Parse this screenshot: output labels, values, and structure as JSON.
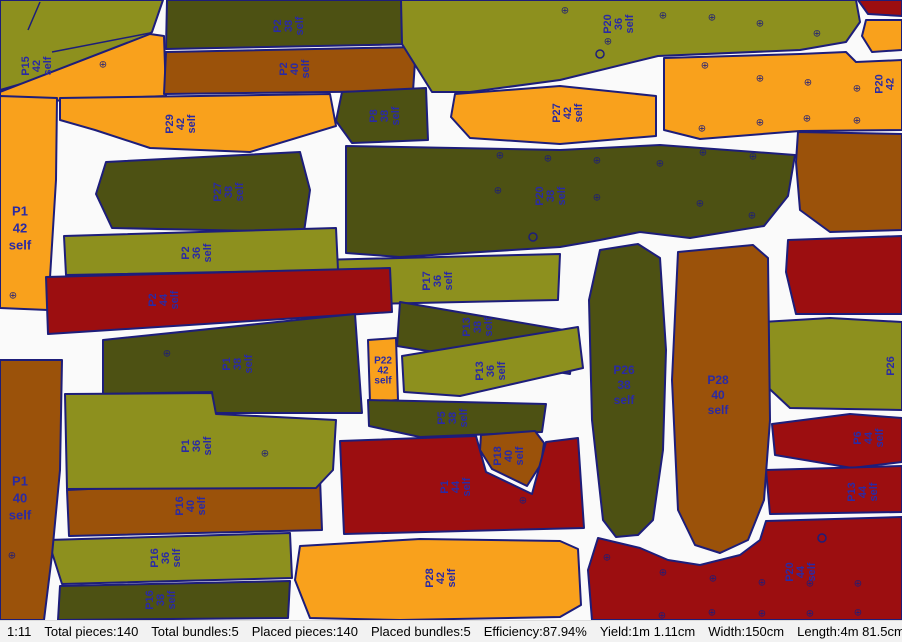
{
  "window": {
    "title": "Marker nesting view"
  },
  "status_bar": {
    "items": [
      "1:11",
      "Total pieces:140",
      "Total bundles:5",
      "Placed pieces:140",
      "Placed bundles:5",
      "Efficiency:87.94%",
      "Yield:1m 1.11cm",
      "Width:150cm",
      "Length:4m 81.5cm"
    ]
  },
  "colors": {
    "size36": "#8d901e",
    "size38": "#4d5113",
    "size40": "#9b520a",
    "size42": "#f9a11c",
    "size44": "#9c0e10",
    "outline": "#1d1d7a",
    "label": "#2a2aa4",
    "background": "#fafafa",
    "statusbar_bg": "#f2f2f2"
  },
  "symbols": {
    "drill": "⊕"
  },
  "canvas": {
    "width": 902,
    "height": 620
  },
  "pieces": [
    {
      "id": "p36-top-left",
      "color": "size36",
      "points": "0,0 163,0 152,32 118,56 0,90",
      "lines": [
        [
          40,
          2,
          28,
          30
        ]
      ]
    },
    {
      "id": "P15-42",
      "color": "size42",
      "points": "0,92 150,34 164,36 166,96 0,103",
      "label": {
        "x": 36,
        "y": 66,
        "rot": -90,
        "lines": [
          "P15",
          "42",
          "self"
        ]
      },
      "drills": [
        [
          103,
          64
        ]
      ],
      "lines": [
        [
          52,
          52,
          150,
          33
        ]
      ]
    },
    {
      "id": "P2-38",
      "color": "size38",
      "points": "167,0 420,0 417,44 166,49",
      "label": {
        "x": 288,
        "y": 26,
        "rot": -90,
        "lines": [
          "P2",
          "38",
          "self"
        ]
      }
    },
    {
      "id": "P2-40",
      "color": "size40",
      "points": "166,52 416,47 413,91 164,94",
      "label": {
        "x": 294,
        "y": 69,
        "rot": -90,
        "lines": [
          "P2",
          "40",
          "self"
        ]
      }
    },
    {
      "id": "P29-42",
      "color": "size42",
      "points": "60,98 200,96 330,94 336,126 250,152 150,148 95,130 60,120",
      "label": {
        "x": 180,
        "y": 124,
        "rot": -90,
        "lines": [
          "P29",
          "42",
          "self"
        ]
      }
    },
    {
      "id": "P1-42",
      "color": "size42",
      "points": "0,96 57,98 56,180 48,310 0,308",
      "label": {
        "x": 20,
        "y": 228,
        "rot": 0,
        "size": 13,
        "lh": 17,
        "lines": [
          "P1",
          "42",
          "self"
        ]
      },
      "drills": [
        [
          13,
          295
        ]
      ]
    },
    {
      "id": "P8-38",
      "color": "size38",
      "points": "342,92 426,88 428,140 352,143 336,121",
      "label": {
        "x": 384,
        "y": 116,
        "rot": -90,
        "lines": [
          "P8",
          "38",
          "self"
        ]
      }
    },
    {
      "id": "P20-36",
      "color": "size36",
      "points": "401,0 856,0 860,22 846,42 800,50 658,56 560,80 470,92 432,92 402,44",
      "label": {
        "x": 618,
        "y": 24,
        "rot": -90,
        "lines": [
          "P20",
          "36",
          "self"
        ]
      },
      "drills": [
        [
          565,
          10
        ],
        [
          663,
          15
        ],
        [
          712,
          17
        ],
        [
          760,
          23
        ],
        [
          817,
          33
        ],
        [
          608,
          41
        ]
      ],
      "circles": [
        [
          600,
          54
        ]
      ]
    },
    {
      "id": "P27-42",
      "color": "size42",
      "points": "455,94 560,86 656,96 656,136 560,144 470,138 451,117",
      "label": {
        "x": 567,
        "y": 113,
        "rot": -90,
        "lines": [
          "P27",
          "42",
          "self"
        ]
      }
    },
    {
      "id": "P20-42",
      "color": "size42",
      "points": "664,58 800,54 846,52 856,62 902,60 902,130 800,131 700,139 664,130",
      "label": {
        "x": 884,
        "y": 84,
        "rot": -90,
        "lines": [
          "P20",
          "42"
        ]
      },
      "drills": [
        [
          705,
          65
        ],
        [
          760,
          78
        ],
        [
          808,
          82
        ],
        [
          857,
          88
        ],
        [
          702,
          128
        ],
        [
          760,
          122
        ],
        [
          807,
          118
        ],
        [
          857,
          120
        ]
      ]
    },
    {
      "id": "p44-wedge-tr",
      "color": "size44",
      "points": "858,0 902,0 902,16 868,14"
    },
    {
      "id": "p42-wedge-tr",
      "color": "size42",
      "points": "866,20 902,20 902,50 872,52 862,36"
    },
    {
      "id": "P20-38",
      "color": "size38",
      "points": "346,146 560,150 660,145 795,155 788,196 764,226 690,238 640,232 600,240 560,247 400,257 346,253",
      "label": {
        "x": 550,
        "y": 196,
        "rot": -90,
        "lines": [
          "P20",
          "38",
          "self"
        ]
      },
      "drills": [
        [
          500,
          155
        ],
        [
          548,
          158
        ],
        [
          597,
          160
        ],
        [
          498,
          190
        ],
        [
          597,
          197
        ],
        [
          660,
          163
        ],
        [
          703,
          152
        ],
        [
          753,
          156
        ],
        [
          700,
          203
        ],
        [
          752,
          215
        ]
      ],
      "circles": [
        [
          533,
          237
        ]
      ]
    },
    {
      "id": "p40-right",
      "color": "size40",
      "points": "798,132 902,134 902,230 830,232 800,210 796,162"
    },
    {
      "id": "p44-right",
      "color": "size44",
      "points": "788,240 902,236 902,314 796,314 786,272"
    },
    {
      "id": "P26-36",
      "color": "size36",
      "points": "762,322 830,318 902,322 902,410 790,408 760,380 754,344",
      "label": {
        "x": 890,
        "y": 366,
        "rot": -90,
        "lines": [
          "P26"
        ]
      }
    },
    {
      "id": "P6-44",
      "color": "size44",
      "points": "772,424 850,414 902,418 902,462 852,468 775,455",
      "label": {
        "x": 868,
        "y": 438,
        "rot": -90,
        "lines": [
          "P6",
          "44",
          "self"
        ]
      }
    },
    {
      "id": "P13-44",
      "color": "size44",
      "points": "766,470 902,466 902,512 770,514",
      "label": {
        "x": 862,
        "y": 492,
        "rot": -90,
        "lines": [
          "P13",
          "44",
          "self"
        ]
      }
    },
    {
      "id": "P17-36",
      "color": "size36",
      "points": "318,260 560,254 558,300 321,305",
      "label": {
        "x": 437,
        "y": 281,
        "rot": -90,
        "lines": [
          "P17",
          "36",
          "self"
        ]
      }
    },
    {
      "id": "P27-38",
      "color": "size38",
      "points": "106,162 300,152 310,190 304,232 112,228 96,194",
      "label": {
        "x": 228,
        "y": 192,
        "rot": -90,
        "lines": [
          "P27",
          "38",
          "self"
        ]
      }
    },
    {
      "id": "P2-36",
      "color": "size36",
      "points": "64,236 336,228 338,270 66,275",
      "label": {
        "x": 196,
        "y": 253,
        "rot": -90,
        "lines": [
          "P2",
          "36",
          "self"
        ]
      }
    },
    {
      "id": "P2-44",
      "color": "size44",
      "points": "46,277 390,268 392,312 48,334",
      "label": {
        "x": 163,
        "y": 300,
        "rot": -90,
        "lines": [
          "P2",
          "44",
          "self"
        ]
      }
    },
    {
      "id": "P1-38",
      "color": "size38",
      "points": "103,340 355,314 362,413 214,413 212,392 103,394",
      "label": {
        "x": 237,
        "y": 364,
        "rot": -90,
        "lines": [
          "P1",
          "38",
          "self"
        ]
      },
      "drills": [
        [
          167,
          353
        ]
      ]
    },
    {
      "id": "P22-42",
      "color": "size42",
      "points": "368,340 396,338 398,400 370,402",
      "label": {
        "x": 383,
        "y": 370,
        "rot": 0,
        "size": 10,
        "lh": 10,
        "lines": [
          "P22",
          "42",
          "self"
        ]
      }
    },
    {
      "id": "P13-38",
      "color": "size38",
      "points": "400,302 575,332 570,374 397,346",
      "label": {
        "x": 477,
        "y": 327,
        "rot": -90,
        "lines": [
          "P13",
          "38",
          "self"
        ]
      }
    },
    {
      "id": "P13-36",
      "color": "size36",
      "points": "402,356 578,327 583,368 460,396 404,392",
      "label": {
        "x": 490,
        "y": 371,
        "rot": -90,
        "lines": [
          "P13",
          "36",
          "self"
        ]
      }
    },
    {
      "id": "P5-38",
      "color": "size38",
      "points": "368,400 546,404 542,432 420,437 369,426",
      "label": {
        "x": 452,
        "y": 418,
        "rot": -90,
        "lines": [
          "P5",
          "38",
          "self"
        ]
      }
    },
    {
      "id": "P18-40",
      "color": "size40",
      "points": "481,435 535,431 544,443 541,464 527,486 492,469 480,450",
      "label": {
        "x": 508,
        "y": 456,
        "rot": -90,
        "lines": [
          "P18",
          "40",
          "self"
        ]
      }
    },
    {
      "id": "P1-44",
      "color": "size44",
      "points": "340,441 476,436 486,472 532,494 546,442 578,438 584,528 344,534",
      "label": {
        "x": 455,
        "y": 487,
        "rot": -90,
        "lines": [
          "P1",
          "44",
          "self"
        ]
      },
      "drills": [
        [
          523,
          500
        ]
      ]
    },
    {
      "id": "P26-38",
      "color": "size38",
      "points": "600,250 638,244 660,258 666,350 663,450 653,520 638,535 616,537 603,520 592,420 589,300",
      "label": {
        "x": 624,
        "y": 385,
        "rot": 0,
        "size": 12,
        "lh": 15,
        "lines": [
          "P26",
          "38",
          "self"
        ]
      }
    },
    {
      "id": "P28-40",
      "color": "size40",
      "points": "678,252 753,245 768,258 770,420 764,500 748,540 720,553 695,545 678,510 672,380",
      "label": {
        "x": 718,
        "y": 395,
        "rot": 0,
        "size": 12,
        "lh": 15,
        "lines": [
          "P28",
          "40",
          "self"
        ]
      }
    },
    {
      "id": "P28-42",
      "color": "size42",
      "points": "300,546 420,539 560,541 578,549 581,605 560,617 400,620 310,618 295,580",
      "label": {
        "x": 440,
        "y": 578,
        "rot": -90,
        "lines": [
          "P28",
          "42",
          "self"
        ]
      }
    },
    {
      "id": "P20-44",
      "color": "size44",
      "points": "598,538 640,548 668,560 700,565 740,555 760,540 766,521 902,517 902,620 592,620 588,570",
      "label": {
        "x": 800,
        "y": 572,
        "rot": -90,
        "lines": [
          "P20",
          "44",
          "self"
        ]
      },
      "drills": [
        [
          607,
          557
        ],
        [
          663,
          572
        ],
        [
          713,
          578
        ],
        [
          762,
          582
        ],
        [
          662,
          615
        ],
        [
          712,
          612
        ],
        [
          762,
          613
        ],
        [
          810,
          583
        ],
        [
          858,
          583
        ],
        [
          810,
          613
        ],
        [
          858,
          612
        ]
      ],
      "circles": [
        [
          822,
          538
        ]
      ]
    },
    {
      "id": "P16-40",
      "color": "size40",
      "points": "67,490 320,478 322,530 69,536",
      "label": {
        "x": 190,
        "y": 506,
        "rot": -90,
        "lines": [
          "P16",
          "40",
          "self"
        ]
      }
    },
    {
      "id": "P16-36",
      "color": "size36",
      "points": "48,540 290,533 292,578 62,584",
      "label": {
        "x": 165,
        "y": 558,
        "rot": -90,
        "lines": [
          "P16",
          "36",
          "self"
        ]
      }
    },
    {
      "id": "P16-38",
      "color": "size38",
      "points": "60,586 290,581 288,618 58,620",
      "label": {
        "x": 160,
        "y": 600,
        "rot": -90,
        "lines": [
          "P16",
          "38",
          "self"
        ]
      }
    },
    {
      "id": "P1-36",
      "color": "size36",
      "points": "65,394 212,393 216,414 336,420 333,470 316,488 67,489",
      "label": {
        "x": 196,
        "y": 446,
        "rot": -90,
        "lines": [
          "P1",
          "36",
          "self"
        ]
      },
      "drills": [
        [
          265,
          453
        ]
      ]
    },
    {
      "id": "P1-40",
      "color": "size40",
      "points": "0,360 62,360 60,470 52,555 44,620 0,620",
      "label": {
        "x": 20,
        "y": 498,
        "rot": 0,
        "size": 13,
        "lh": 17,
        "lines": [
          "P1",
          "40",
          "self"
        ]
      },
      "drills": [
        [
          12,
          555
        ]
      ]
    }
  ]
}
